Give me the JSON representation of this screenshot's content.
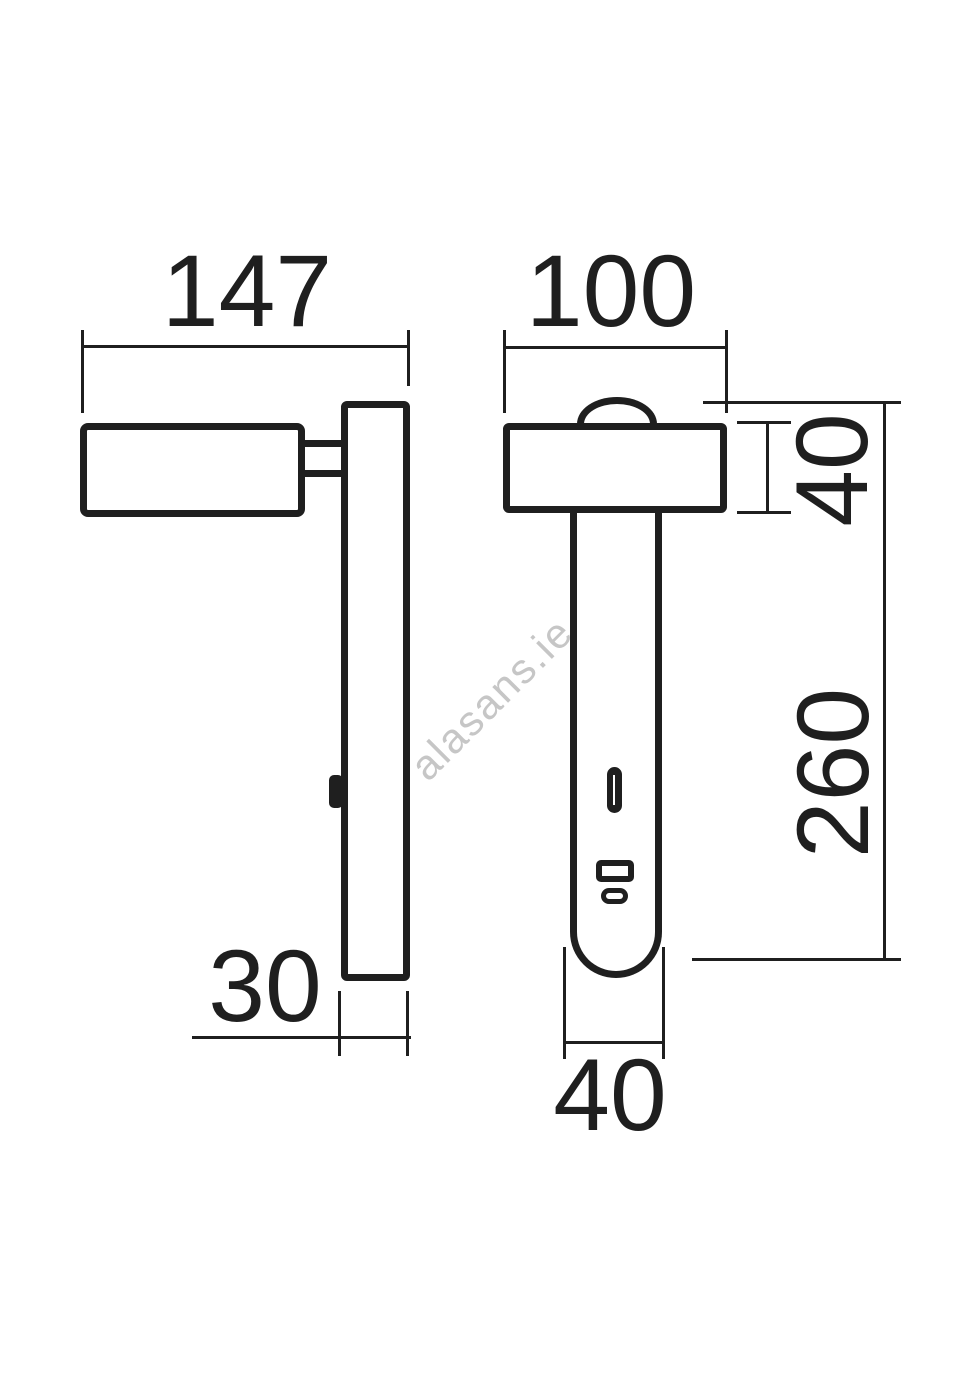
{
  "drawing": {
    "type": "technical-dimension-drawing",
    "line_color": "#1f1f1f",
    "background_color": "#ffffff",
    "views": {
      "side": {
        "overall_width_mm": "147",
        "plate_depth_mm": "30"
      },
      "front": {
        "head_width_mm": "100",
        "head_height_mm": "40",
        "body_height_mm": "260",
        "stem_width_mm": "40"
      }
    }
  },
  "watermark": {
    "text": "alasans.ie",
    "color": "#c6c6c6"
  }
}
